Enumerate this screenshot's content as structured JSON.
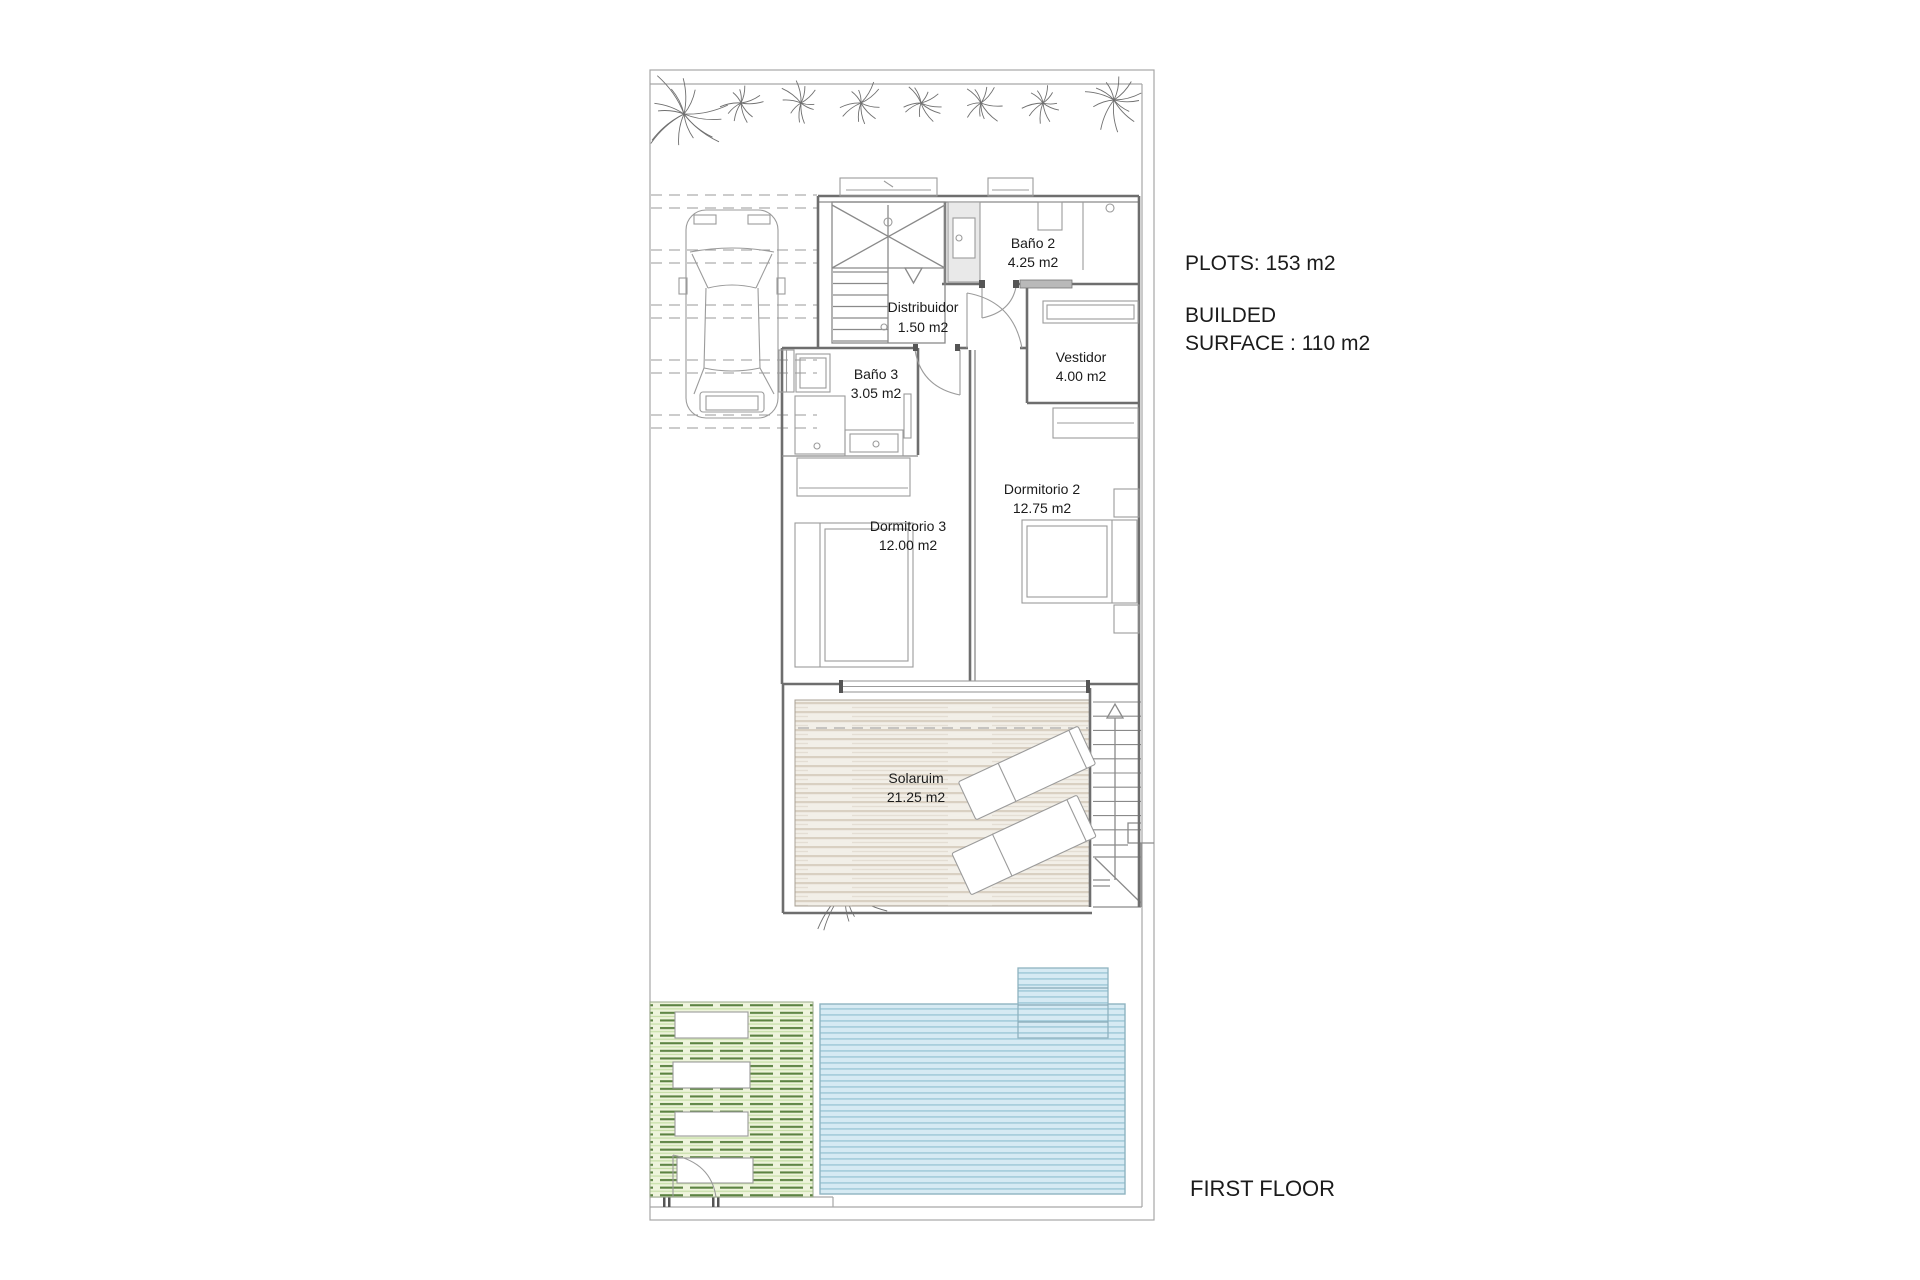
{
  "annotations": {
    "plots": "PLOTS: 153 m2",
    "builded_line1": "BUILDED",
    "builded_line2": "SURFACE : 110 m2",
    "floor_label": "FIRST FLOOR"
  },
  "rooms": [
    {
      "name": "Baño 2",
      "area": "4.25 m2"
    },
    {
      "name": "Distribuidor",
      "area": "1.50 m2"
    },
    {
      "name": "Baño 3",
      "area": "3.05 m2"
    },
    {
      "name": "Vestidor",
      "area": "4.00 m2"
    },
    {
      "name": "Dormitorio 2",
      "area": "12.75 m2"
    },
    {
      "name": "Dormitorio 3",
      "area": "12.00 m2"
    },
    {
      "name": "Solaruim",
      "area": "21.25 m2"
    }
  ],
  "colors": {
    "wall": "#6e6e6e",
    "fixture": "#9b9b9b",
    "boundary": "#a6a6a6",
    "text": "#1b1b1b",
    "deck_base": "#f2efe8",
    "deck_stripe": "#d9d0c2",
    "pool_base": "#d6eaf3",
    "pool_stripe": "#a9cfdd",
    "pool_edge": "#8fb3c0",
    "green_base": "#eef4dc",
    "green_stripe": "#5c8342",
    "green_light": "#c8dfa9"
  }
}
